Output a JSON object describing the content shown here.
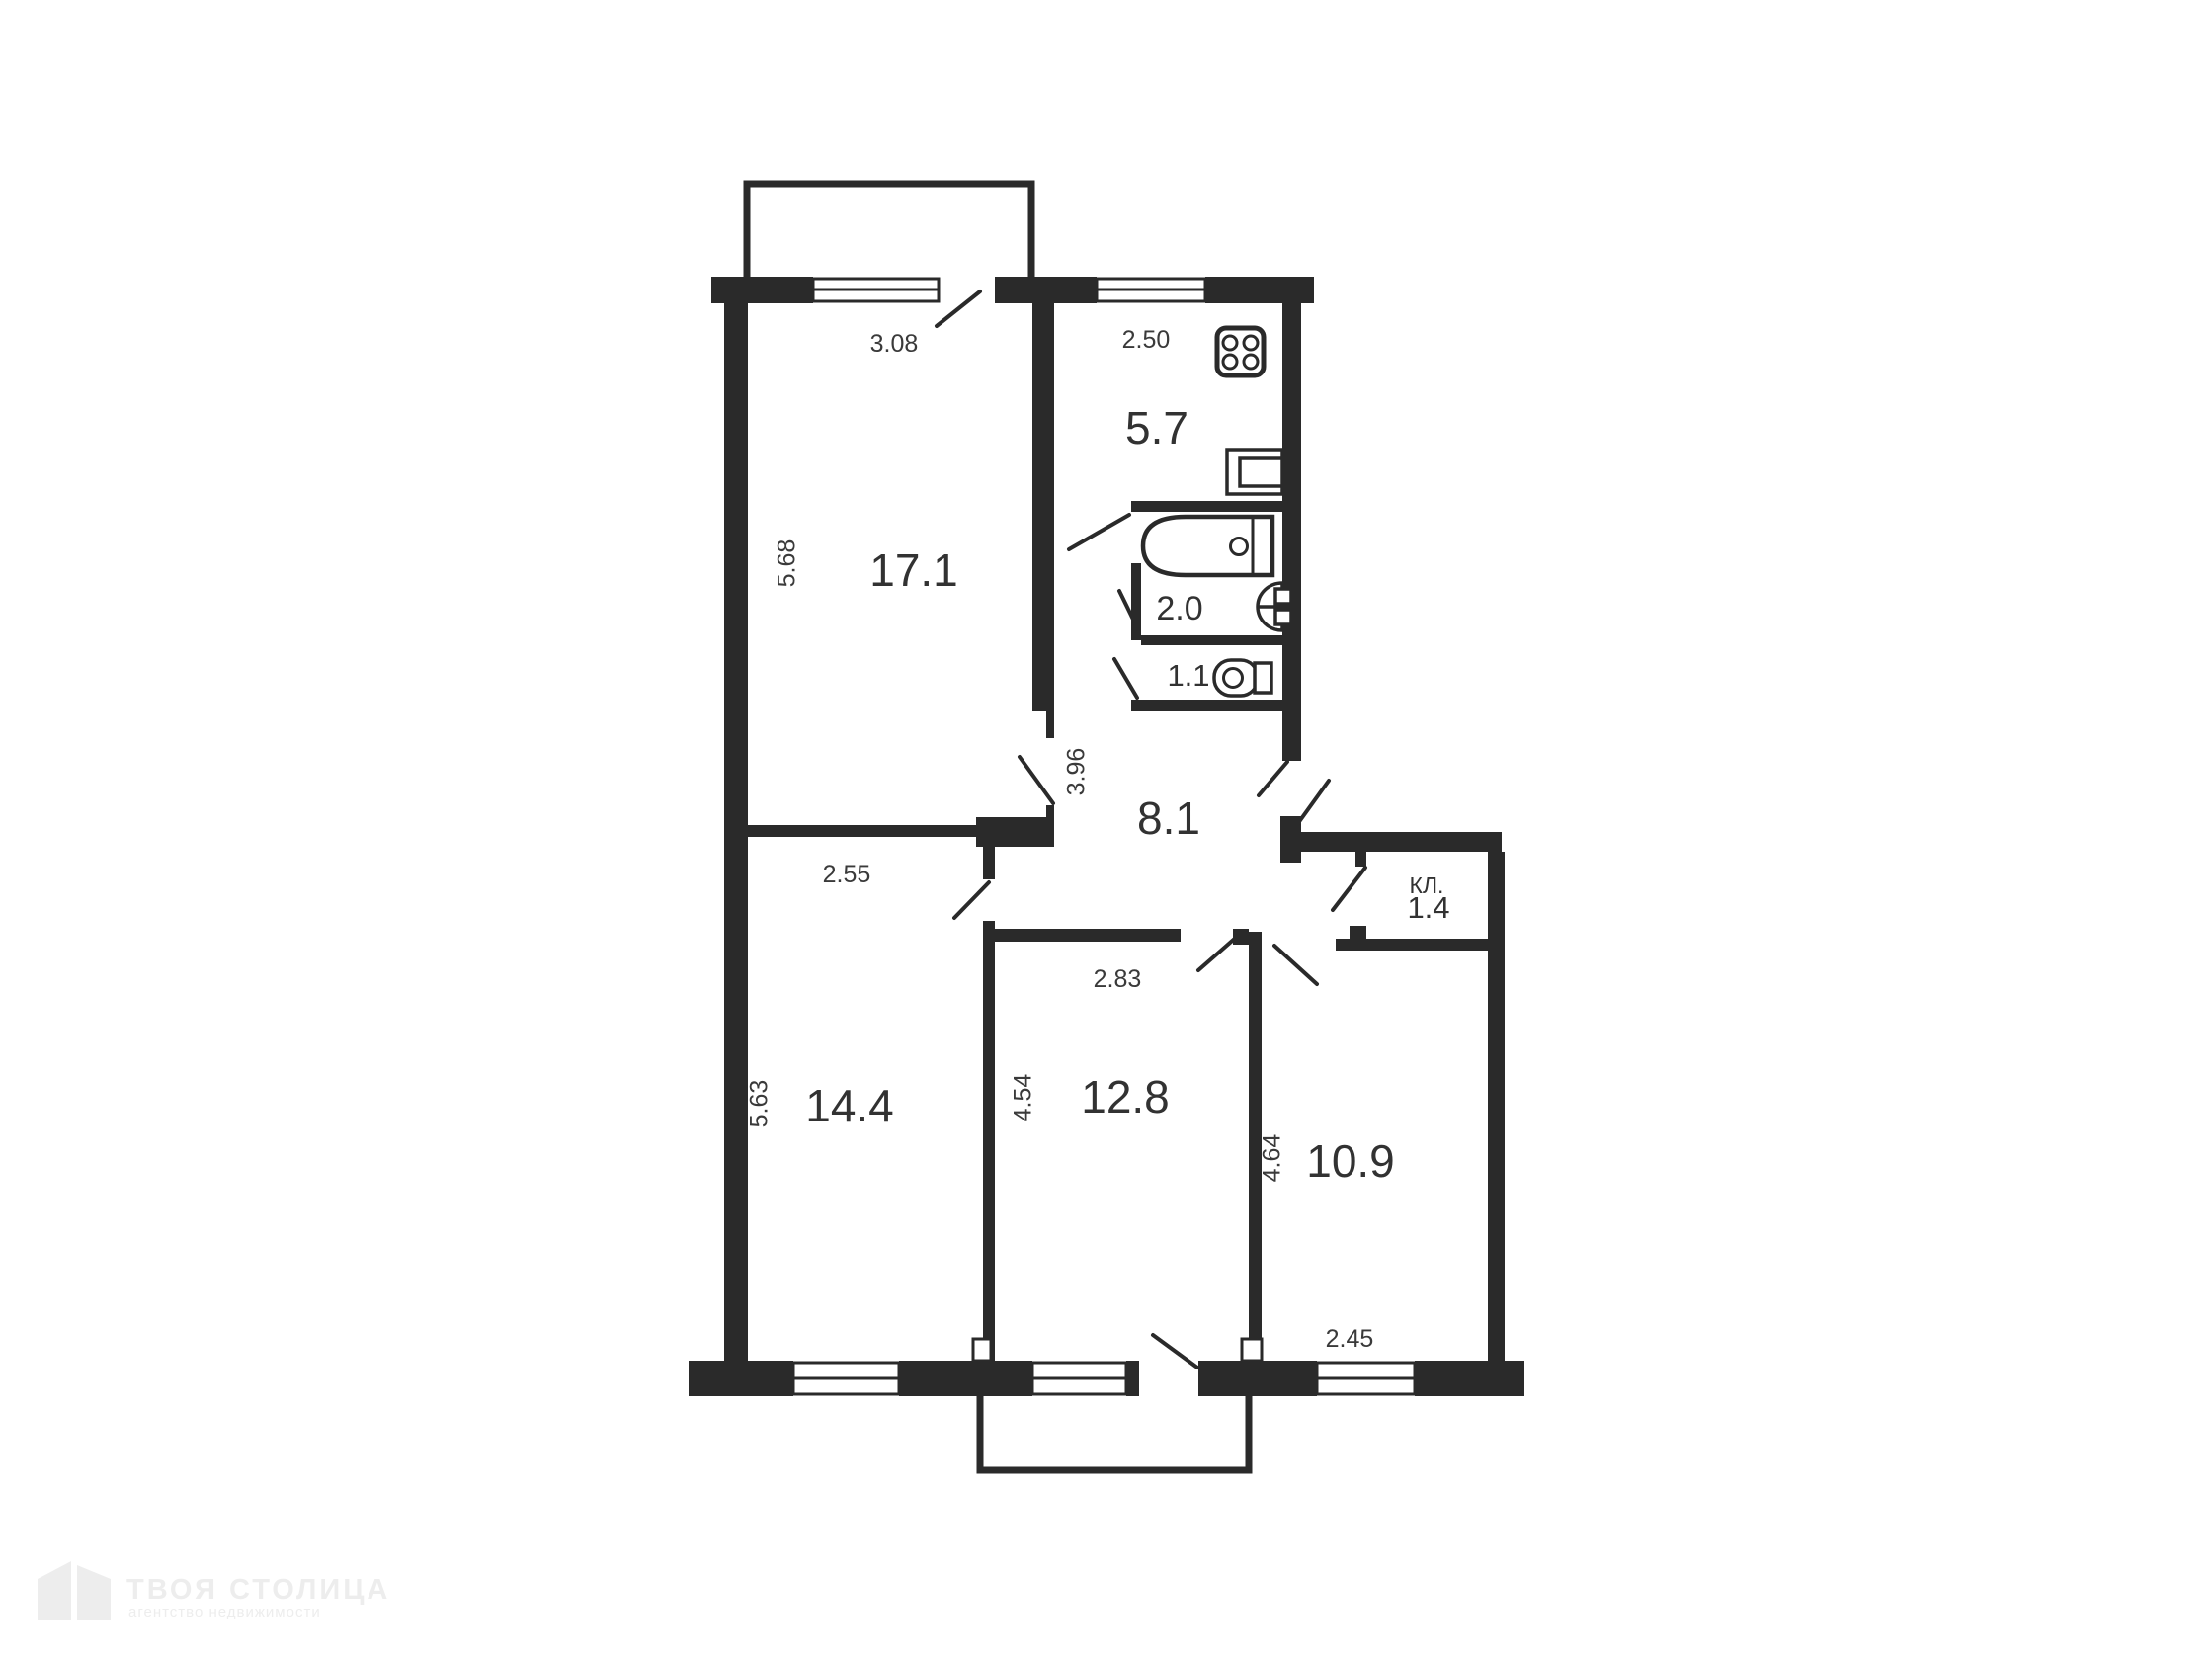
{
  "plan": {
    "colors": {
      "wall": "#2a2a2a",
      "text": "#323232",
      "background": "#ffffff",
      "watermark": "#ededed"
    },
    "rooms": {
      "living": {
        "area": "17.1",
        "width_dim": "3.08",
        "height_dim": "5.68"
      },
      "kitchen": {
        "area": "5.7",
        "width_dim": "2.50"
      },
      "bath": {
        "area": "2.0"
      },
      "wc": {
        "area": "1.1"
      },
      "hall": {
        "area": "8.1",
        "height_dim": "3.96"
      },
      "closet": {
        "label": "КЛ.",
        "area": "1.4"
      },
      "bedroom_left": {
        "area": "14.4",
        "width_dim": "2.55",
        "height_dim": "5.63"
      },
      "bedroom_middle": {
        "area": "12.8",
        "width_dim": "2.83",
        "height_dim": "4.54"
      },
      "bedroom_right": {
        "area": "10.9",
        "width_dim": "2.45",
        "height_dim": "4.64"
      }
    },
    "fixtures": [
      "stove",
      "kitchen-sink",
      "bathtub",
      "washbasin",
      "toilet"
    ],
    "watermark": {
      "title": "ТВОЯ СТОЛИЦА",
      "subtitle": "агентство недвижимости"
    }
  }
}
